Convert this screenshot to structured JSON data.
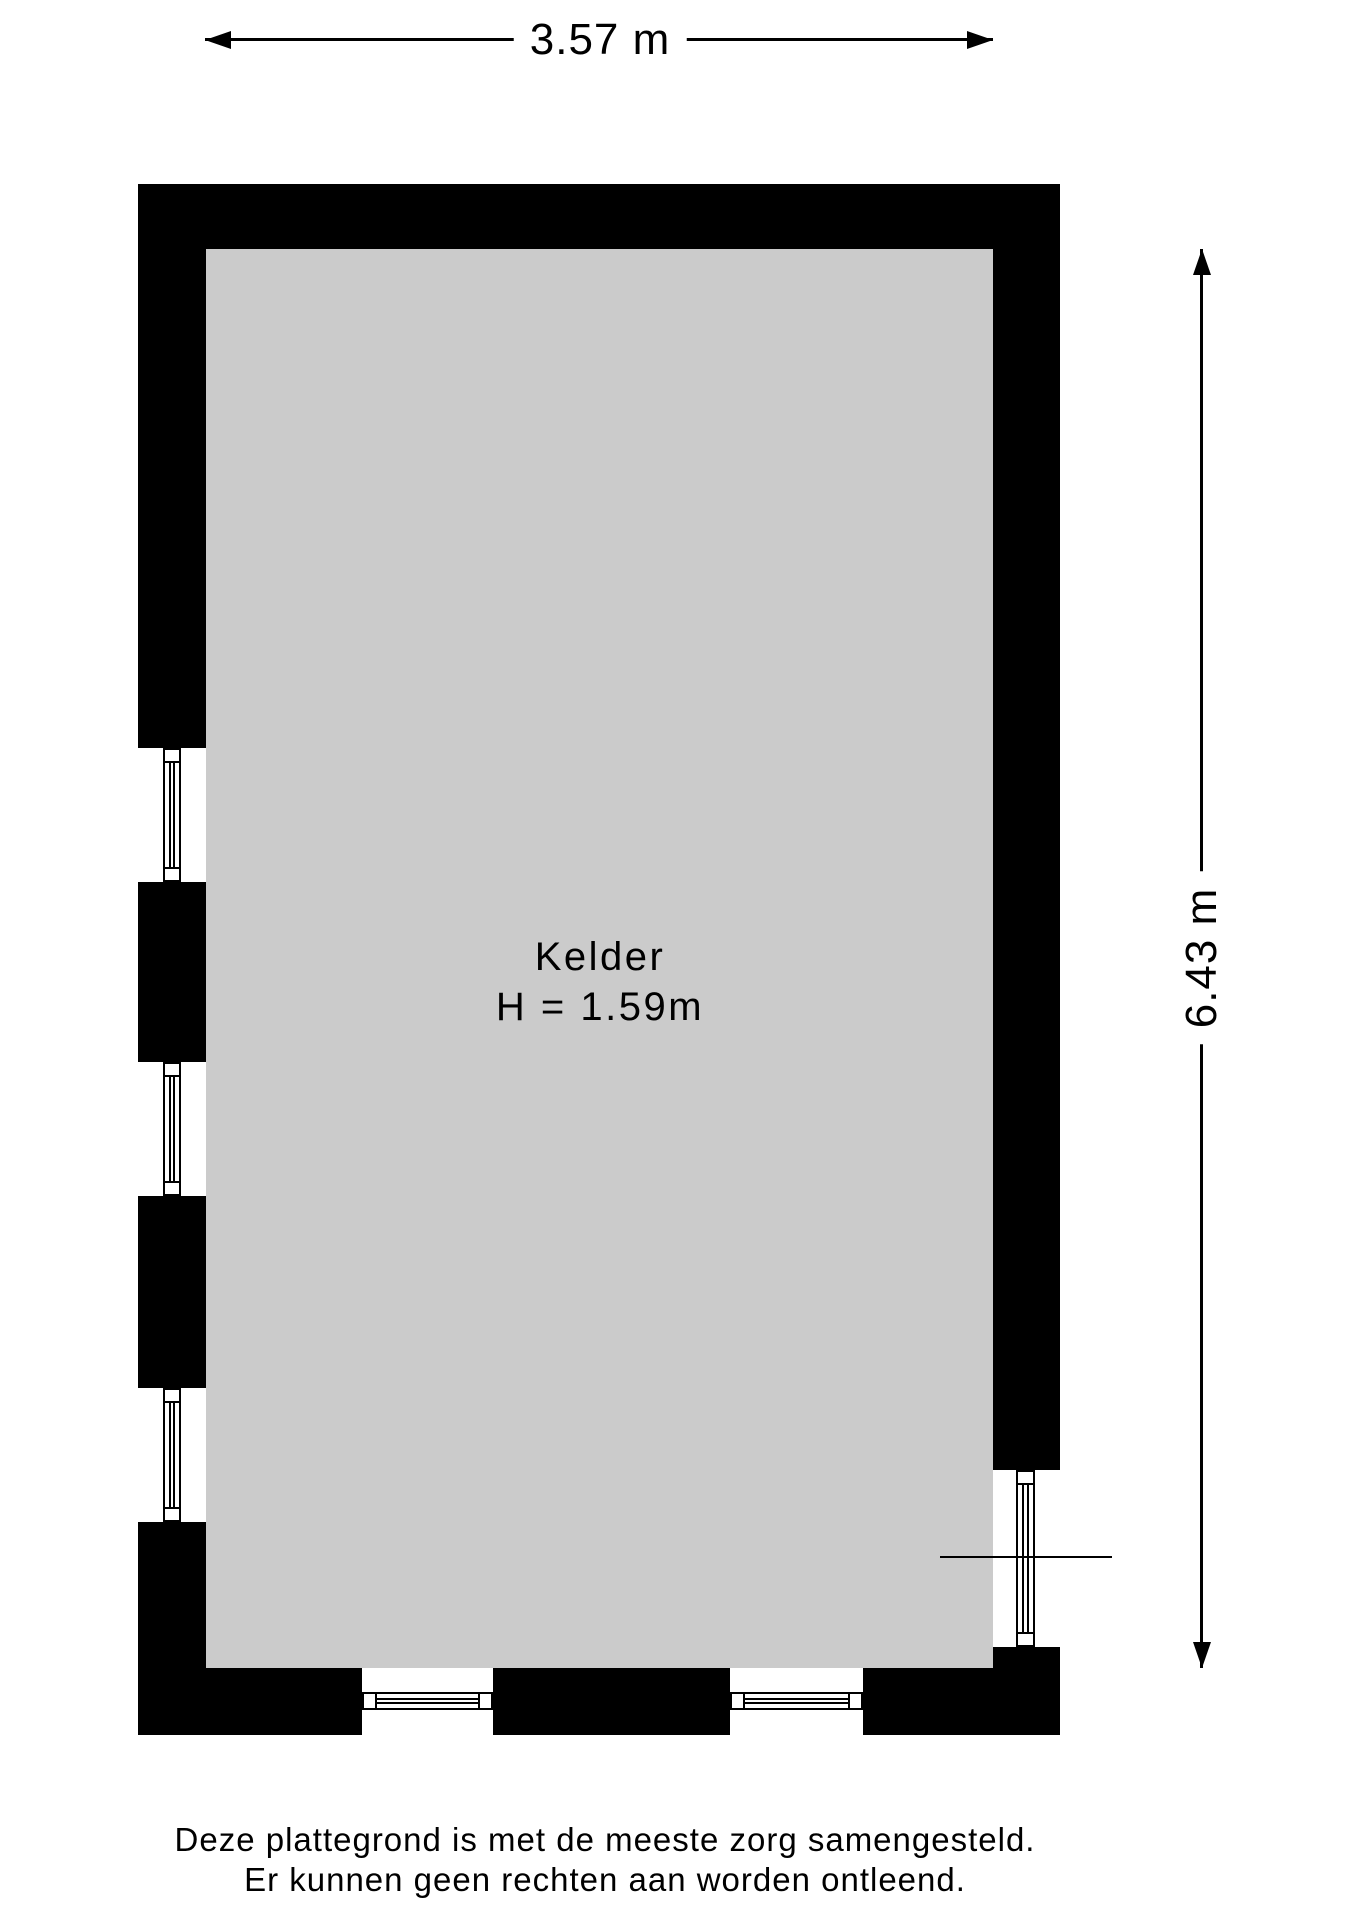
{
  "plan": {
    "room_name": "Kelder",
    "room_height_label": "H = 1.59m",
    "floor_color": "#cbcbcb",
    "wall_color": "#000000"
  },
  "dimensions": {
    "width_label": "3.57 m",
    "height_label": "6.43 m"
  },
  "disclaimer": {
    "line1": "Deze plattegrond is met de meeste zorg samengesteld.",
    "line2": "Er kunnen geen rechten aan worden ontleend."
  }
}
